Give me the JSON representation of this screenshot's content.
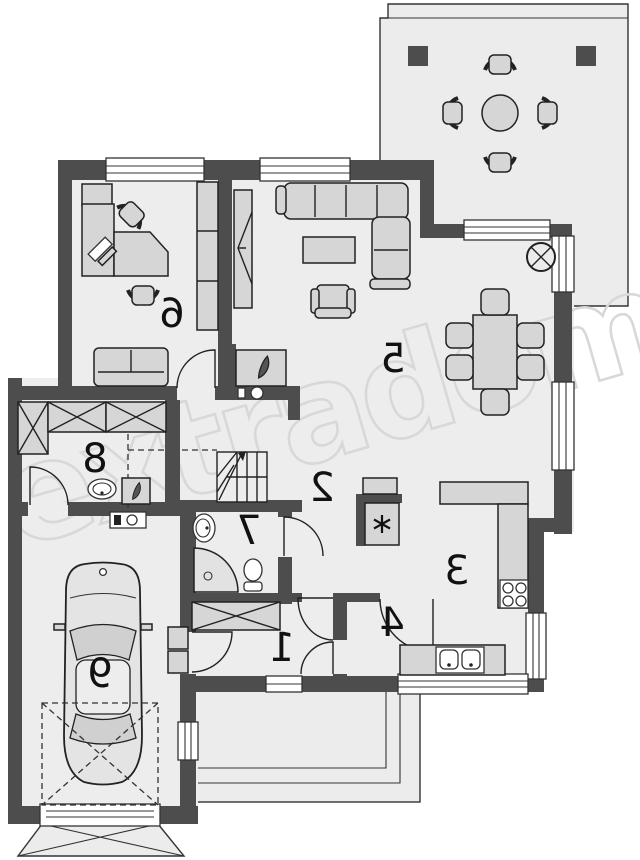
{
  "page": {
    "background": "#ffffff"
  },
  "watermark": {
    "text": "extradom",
    "color": "#d8d8d8"
  },
  "palette": {
    "wall": "#4d4d4d",
    "floor": "#ededed",
    "terrace": "#ececec",
    "furniture": "#d6d6d6",
    "outline": "#222222",
    "label": "#111111"
  },
  "rooms": {
    "vestibule": {
      "number": "1"
    },
    "hall": {
      "number": "2"
    },
    "kitchen": {
      "number": "3"
    },
    "pantry": {
      "number": "4"
    },
    "living_room": {
      "number": "5"
    },
    "office": {
      "number": "6"
    },
    "bathroom": {
      "number": "7"
    },
    "utility_room": {
      "number": "8"
    },
    "garage": {
      "number": "9"
    }
  },
  "symbols": {
    "fireplace": "flame-icon",
    "boiler": "flame-icon",
    "refrigerator": "asterisk-snowflake-icon",
    "ceiling_fixture": "circled-x-icon"
  }
}
